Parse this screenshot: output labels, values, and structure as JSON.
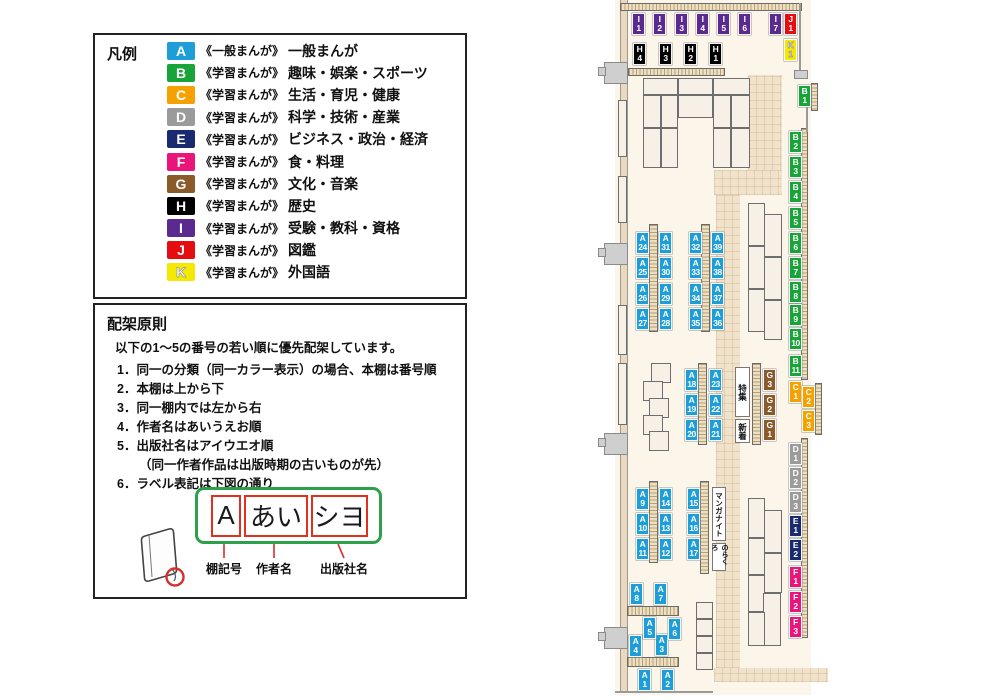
{
  "legend": {
    "title": "凡例",
    "items": [
      {
        "code": "A",
        "color": "#1e9ed8",
        "series": "《一般まんが》",
        "category": "一般まんが"
      },
      {
        "code": "B",
        "color": "#18a438",
        "series": "《学習まんが》",
        "category": "趣味・娯楽・スポーツ"
      },
      {
        "code": "C",
        "color": "#f5a100",
        "series": "《学習まんが》",
        "category": "生活・育児・健康"
      },
      {
        "code": "D",
        "color": "#9b9b9b",
        "series": "《学習まんが》",
        "category": "科学・技術・産業"
      },
      {
        "code": "E",
        "color": "#1a2a70",
        "series": "《学習まんが》",
        "category": "ビジネス・政治・経済"
      },
      {
        "code": "F",
        "color": "#e9157a",
        "series": "《学習まんが》",
        "category": "食・料理"
      },
      {
        "code": "G",
        "color": "#8a5a2b",
        "series": "《学習まんが》",
        "category": "文化・音楽"
      },
      {
        "code": "H",
        "color": "#000000",
        "series": "《学習まんが》",
        "category": "歴史"
      },
      {
        "code": "I",
        "color": "#5a2a8e",
        "series": "《学習まんが》",
        "category": "受験・教科・資格"
      },
      {
        "code": "J",
        "color": "#e60d11",
        "series": "《学習まんが》",
        "category": "図鑑"
      },
      {
        "code": "K",
        "color": "#f5e900",
        "series": "《学習まんが》",
        "category": "外国語"
      }
    ]
  },
  "rules": {
    "title": "配架原則",
    "intro": "以下の1～5の番号の若い順に優先配架しています。",
    "items": [
      {
        "no": "1．",
        "text": "同一の分類（同一カラー表示）の場合、本棚は番号順"
      },
      {
        "no": "2．",
        "text": "本棚は上から下"
      },
      {
        "no": "3．",
        "text": "同一棚内では左から右"
      },
      {
        "no": "4．",
        "text": "作者名はあいうえお順"
      },
      {
        "no": "5．",
        "text": "出版社名はアイウエオ順",
        "text2": "（同一作者作品は出版時期の古いものが先）"
      },
      {
        "no": "6．",
        "text": "ラベル表記は下図の通り"
      }
    ],
    "label_diagram": {
      "boxes": [
        "A",
        "あい",
        "シヨ"
      ],
      "captions": [
        "棚記号",
        "作者名",
        "出版社名"
      ]
    }
  },
  "map": {
    "colors": {
      "A": "#1e9ed8",
      "B": "#18a438",
      "C": "#f5a100",
      "D": "#9b9b9b",
      "E": "#1a2a70",
      "F": "#e9157a",
      "G": "#8a5a2b",
      "H": "#000000",
      "I": "#5a2a8e",
      "J": "#e60d11",
      "K": "#f5e900"
    },
    "shelf_labels": [
      "A1",
      "A2",
      "A3",
      "A4",
      "A5",
      "A6",
      "A7",
      "A8",
      "A9",
      "A10",
      "A11",
      "A12",
      "A13",
      "A14",
      "A15",
      "A16",
      "A17",
      "A18",
      "A19",
      "A20",
      "A21",
      "A22",
      "A23",
      "A24",
      "A25",
      "A26",
      "A27",
      "A28",
      "A29",
      "A30",
      "A31",
      "A32",
      "A33",
      "A34",
      "A35",
      "A36",
      "A37",
      "A38",
      "A39",
      "B1",
      "B2",
      "B3",
      "B4",
      "B5",
      "B6",
      "B7",
      "B8",
      "B9",
      "B10",
      "B11",
      "C1",
      "C2",
      "C3",
      "D1",
      "D2",
      "D3",
      "E1",
      "E2",
      "F1",
      "F2",
      "F3",
      "G1",
      "G2",
      "G3",
      "H1",
      "H2",
      "H3",
      "H4",
      "I1",
      "I2",
      "I3",
      "I4",
      "I5",
      "I6",
      "I7",
      "J1",
      "K1"
    ],
    "special_labels": [
      {
        "id": "tokushu",
        "text": "特集"
      },
      {
        "id": "shinchaku",
        "text": "新着"
      },
      {
        "id": "manganight",
        "text": "マンガナイト"
      },
      {
        "id": "norakuro",
        "text": "のらくろ"
      }
    ]
  }
}
